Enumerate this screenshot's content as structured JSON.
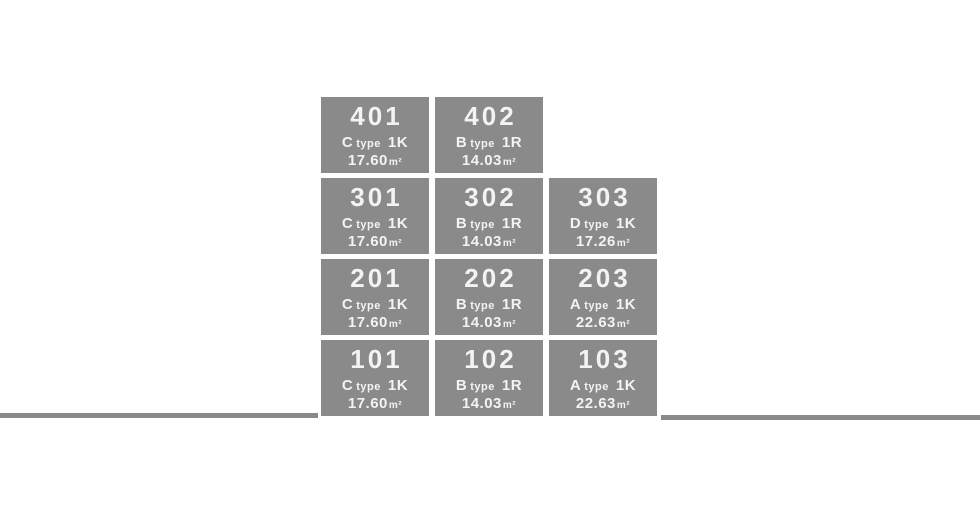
{
  "palette": {
    "block_bg": "#8a8a8a",
    "block_text": "#f3f3f3",
    "ground_line": "#8a8a8a",
    "page_bg": "#ffffff"
  },
  "building": {
    "floors": [
      {
        "rooms": [
          {
            "number": "401",
            "plan": "C",
            "plan_suffix": "type",
            "layout": "1K",
            "area": "17.60",
            "area_unit": "m²"
          },
          {
            "number": "402",
            "plan": "B",
            "plan_suffix": "type",
            "layout": "1R",
            "area": "14.03",
            "area_unit": "m²"
          }
        ]
      },
      {
        "rooms": [
          {
            "number": "301",
            "plan": "C",
            "plan_suffix": "type",
            "layout": "1K",
            "area": "17.60",
            "area_unit": "m²"
          },
          {
            "number": "302",
            "plan": "B",
            "plan_suffix": "type",
            "layout": "1R",
            "area": "14.03",
            "area_unit": "m²"
          },
          {
            "number": "303",
            "plan": "D",
            "plan_suffix": "type",
            "layout": "1K",
            "area": "17.26",
            "area_unit": "m²"
          }
        ]
      },
      {
        "rooms": [
          {
            "number": "201",
            "plan": "C",
            "plan_suffix": "type",
            "layout": "1K",
            "area": "17.60",
            "area_unit": "m²"
          },
          {
            "number": "202",
            "plan": "B",
            "plan_suffix": "type",
            "layout": "1R",
            "area": "14.03",
            "area_unit": "m²"
          },
          {
            "number": "203",
            "plan": "A",
            "plan_suffix": "type",
            "layout": "1K",
            "area": "22.63",
            "area_unit": "m²"
          }
        ]
      },
      {
        "rooms": [
          {
            "number": "101",
            "plan": "C",
            "plan_suffix": "type",
            "layout": "1K",
            "area": "17.60",
            "area_unit": "m²"
          },
          {
            "number": "102",
            "plan": "B",
            "plan_suffix": "type",
            "layout": "1R",
            "area": "14.03",
            "area_unit": "m²"
          },
          {
            "number": "103",
            "plan": "A",
            "plan_suffix": "type",
            "layout": "1K",
            "area": "22.63",
            "area_unit": "m²"
          }
        ]
      }
    ]
  }
}
